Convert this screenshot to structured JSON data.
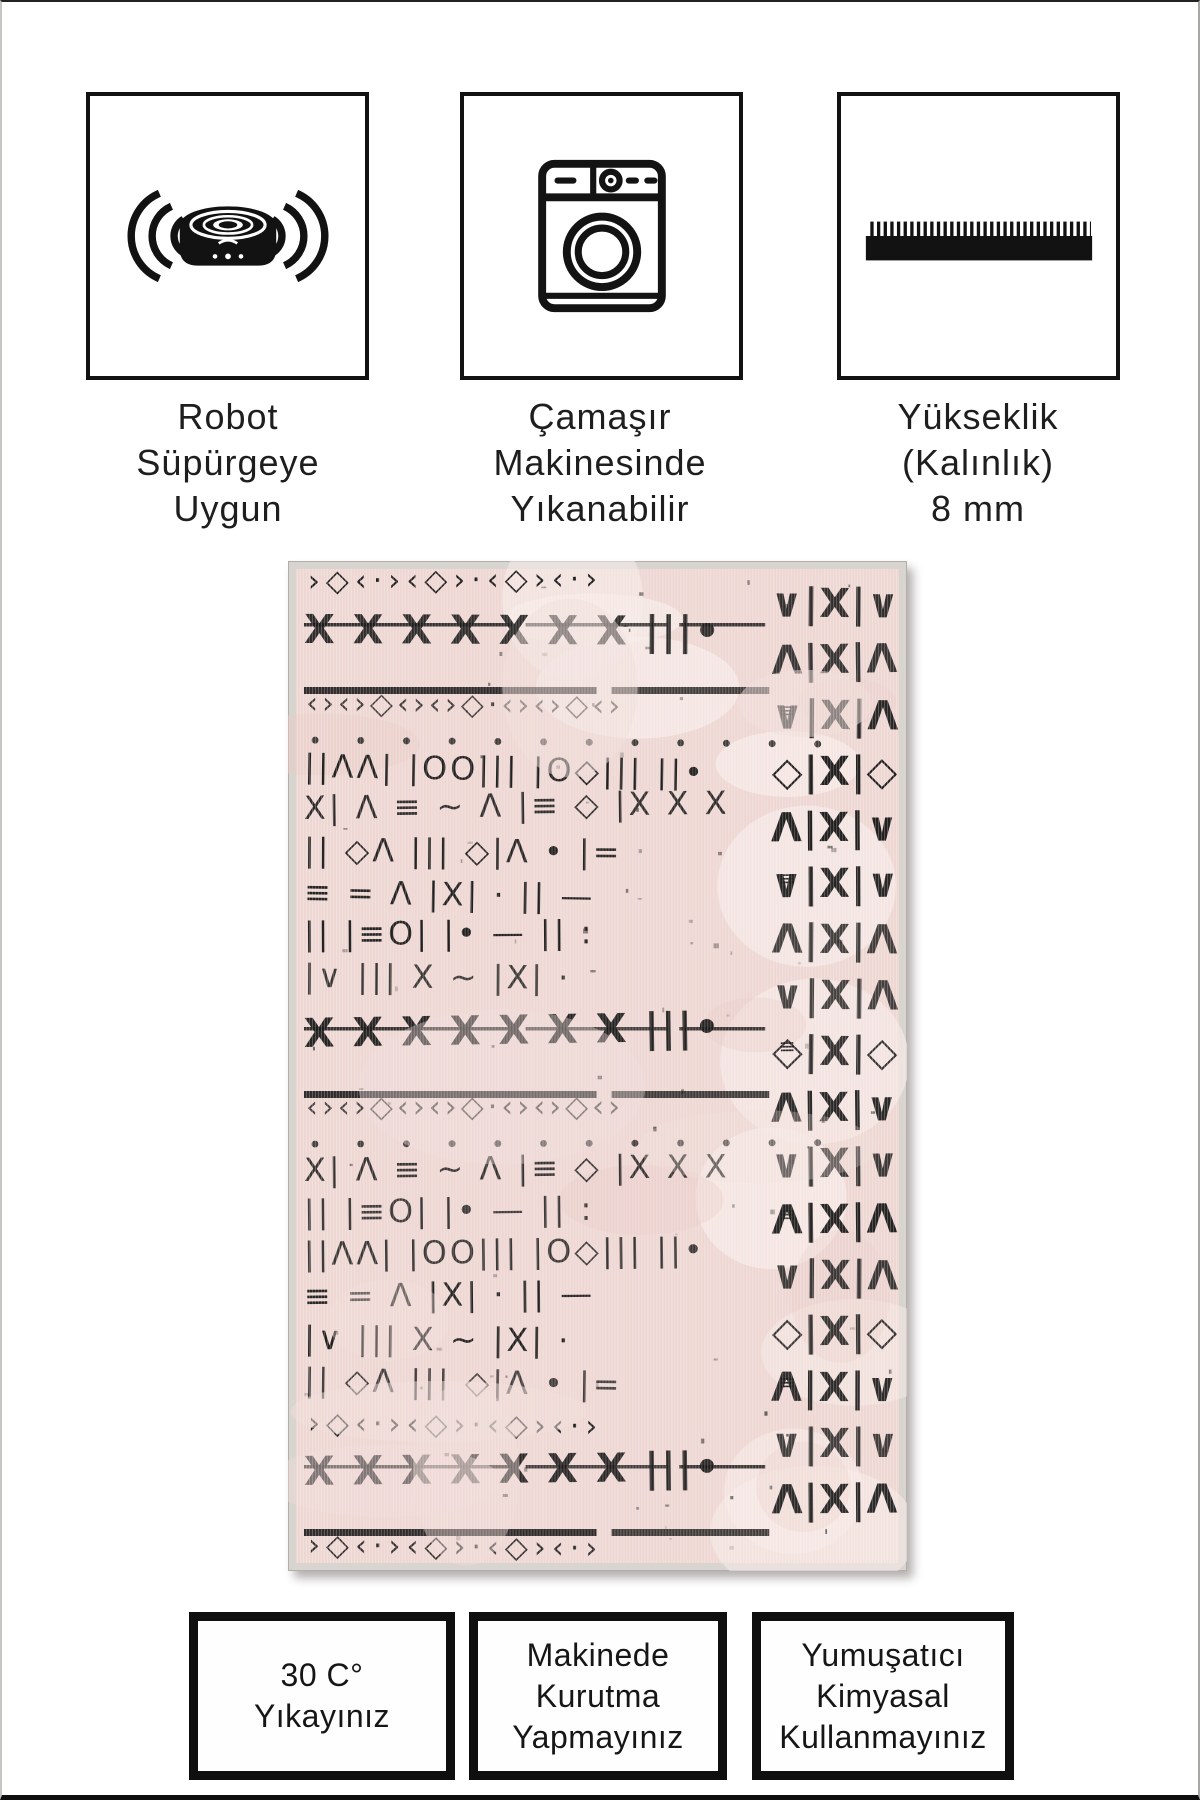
{
  "canvas": {
    "background": "#ffffff",
    "frame_color": "#111111"
  },
  "features": [
    {
      "icon": "robot-vacuum-icon",
      "lines": [
        "Robot",
        "Süpürgeye",
        "Uygun"
      ]
    },
    {
      "icon": "washing-machine-icon",
      "lines": [
        "Çamaşır",
        "Makinesinde",
        "Yıkanabilir"
      ]
    },
    {
      "icon": "pile-height-icon",
      "lines": [
        "Yükseklik",
        "(Kalınlık)",
        "8 mm"
      ]
    }
  ],
  "care_instructions": [
    {
      "lines": [
        "30 C°",
        "Yıkayınız"
      ]
    },
    {
      "lines": [
        "Makinede",
        "Kurutma",
        "Yapmayınız"
      ]
    },
    {
      "lines": [
        "Yumuşatıcı",
        "Kimyasal",
        "Kullanmayınız"
      ]
    }
  ],
  "rug": {
    "description": "Pink distressed tribal mudcloth-pattern area rug, black glyph motifs, light gray woven edge",
    "base_color": "#eed7d3",
    "pattern_color": "#1b1a19",
    "edge_color": "#d8d4d0",
    "highlight_color": "#f7ebe8",
    "shade_color": "#e8cdc8"
  }
}
